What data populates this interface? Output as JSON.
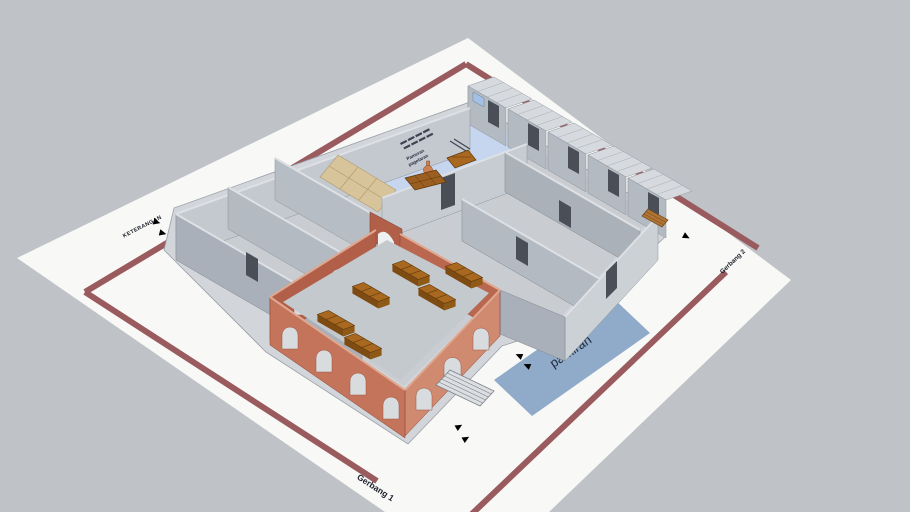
{
  "viewport": {
    "kind": "3d-model-view",
    "background_color": "#bfc2c7",
    "sheet_color": "#f8f8f6"
  },
  "labels": {
    "legend_title": "KETERANGAN",
    "gate1": "Gerbang 1",
    "gate2": "Gerbang 2",
    "parking": "parkiran",
    "courtyard_line1": "Pameran",
    "courtyard_line2": "pagelaran"
  },
  "legend": {
    "icons": [
      "blue-flow-arrow",
      "red-flow-arrow"
    ]
  },
  "icons": [
    "blue-flow-arrow",
    "red-flow-arrow",
    "stairs",
    "ramp"
  ],
  "colors": {
    "background": "#bfc2c7",
    "sheet": "#f8f8f6",
    "site-path": "#9a5b5e",
    "parking-area": "#8fabc9",
    "courtyard-floor": "#c7d6ef",
    "wall-light": "#c9ced4",
    "wall-mid": "#b3bac2",
    "wall-dark": "#a9b0b9",
    "roof": "#d6dade",
    "floor": "#c9cdd2",
    "brick-light": "#d08a70",
    "brick-mid": "#c4745b",
    "brick-dark": "#b25f4a",
    "wood": "#a9681f",
    "wood-dark": "#7e4c13",
    "path-tiles": "#d8c49a",
    "door": "#4a4f57",
    "window": "#a3c1e6",
    "arrow-blue": "#6b96d8",
    "arrow-red": "#b24b4c"
  }
}
